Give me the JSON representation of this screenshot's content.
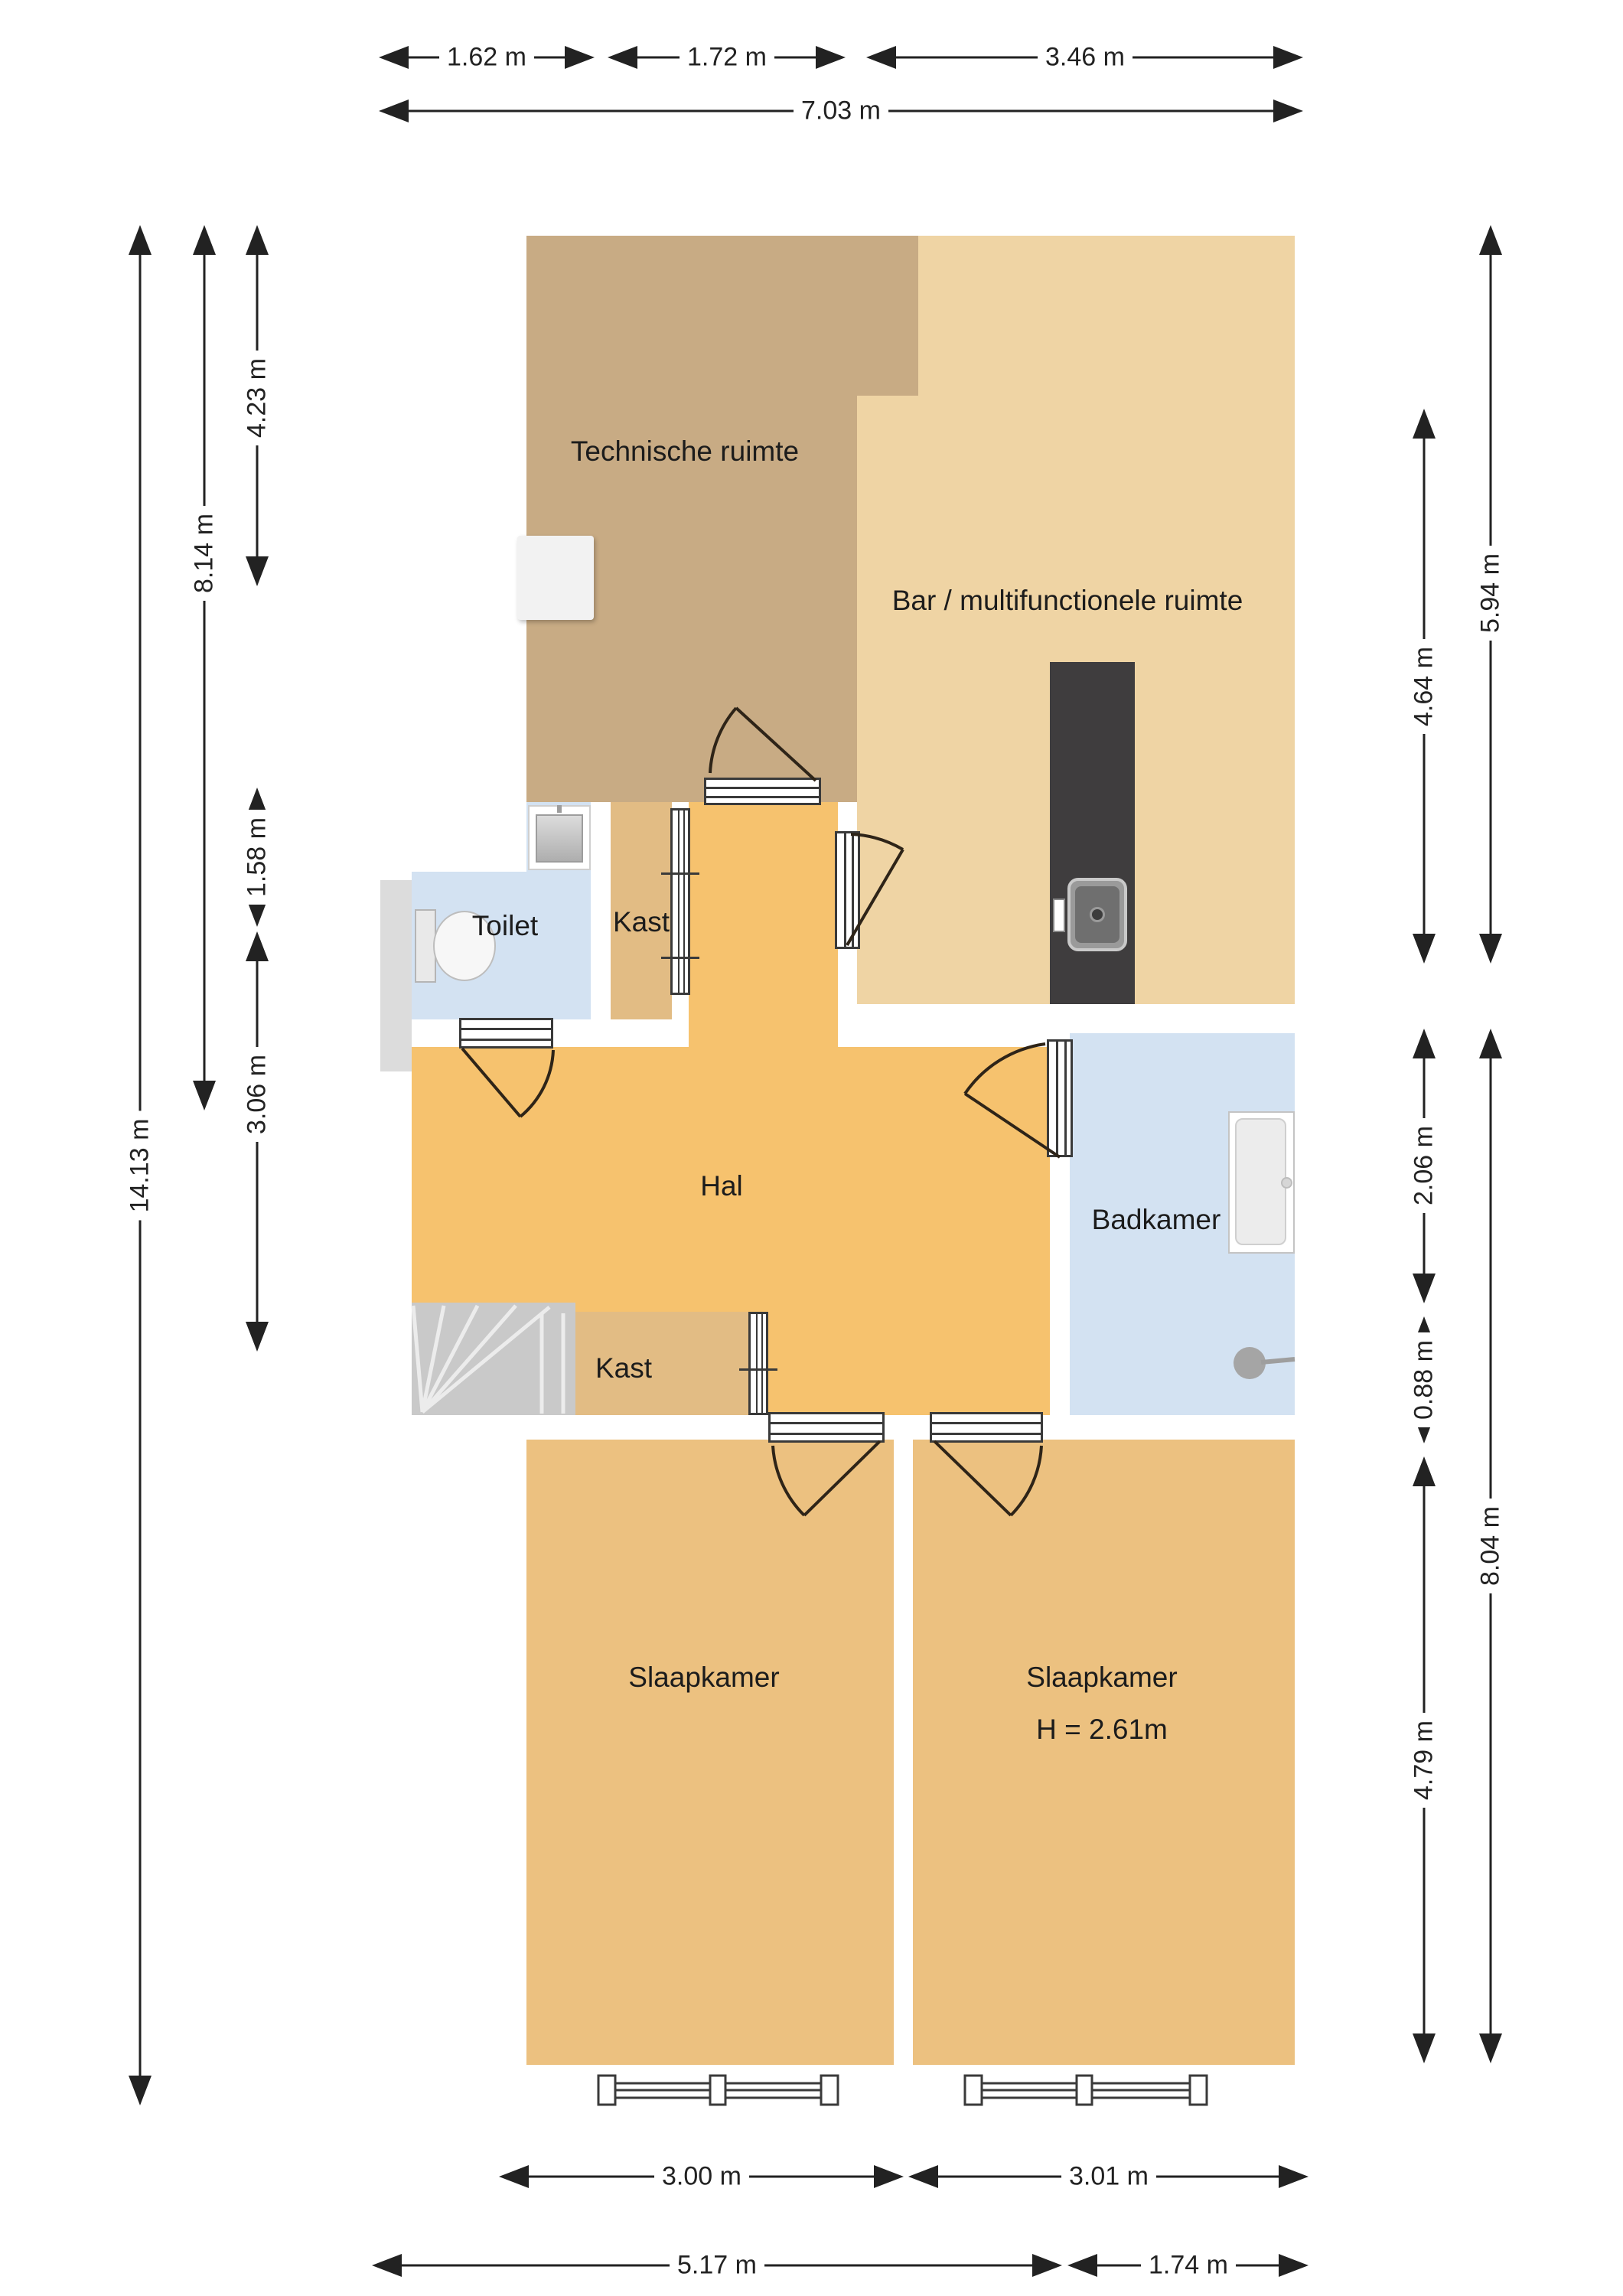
{
  "plan": {
    "title": "floor-plan",
    "colors": {
      "wall": "#0e0e0e",
      "tech": "#c8ab84",
      "bar": "#efd4a4",
      "hal": "#f6c26e",
      "bedroom": "#ecc180",
      "kast": "#e2bc84",
      "wet": "#d3e2f2",
      "stairs": "#c9c9c9",
      "counter": "#3f3d3e",
      "outside": "#ffffff"
    },
    "rooms": [
      {
        "id": "technische-ruimte",
        "label": "Technische ruimte"
      },
      {
        "id": "bar-multifunctionele-ruimte",
        "label": "Bar / multifunctionele ruimte"
      },
      {
        "id": "toilet",
        "label": "Toilet"
      },
      {
        "id": "kast-boven",
        "label": "Kast"
      },
      {
        "id": "hal",
        "label": "Hal"
      },
      {
        "id": "badkamer",
        "label": "Badkamer"
      },
      {
        "id": "kast-onder",
        "label": "Kast"
      },
      {
        "id": "slaapkamer-links",
        "label": "Slaapkamer"
      },
      {
        "id": "slaapkamer-rechts",
        "label": "Slaapkamer",
        "height_note": "H = 2.61m"
      }
    ],
    "dimensions": {
      "top": [
        {
          "label": "1.62 m"
        },
        {
          "label": "1.72 m"
        },
        {
          "label": "3.46 m"
        },
        {
          "label": "7.03 m"
        }
      ],
      "bottom": [
        {
          "label": "3.00 m"
        },
        {
          "label": "3.01 m"
        },
        {
          "label": "5.17 m"
        },
        {
          "label": "1.74 m"
        }
      ],
      "left": [
        {
          "label": "4.23 m"
        },
        {
          "label": "1.58 m"
        },
        {
          "label": "3.06 m"
        },
        {
          "label": "8.14 m"
        },
        {
          "label": "14.13 m"
        }
      ],
      "right": [
        {
          "label": "5.94 m"
        },
        {
          "label": "4.64 m"
        },
        {
          "label": "2.06 m"
        },
        {
          "label": "0.88 m"
        },
        {
          "label": "8.04 m"
        },
        {
          "label": "4.79 m"
        }
      ]
    },
    "fixtures": [
      "stairs",
      "bar-counter",
      "bar-sink",
      "toilet-wc",
      "toilet-sink",
      "bathtub",
      "shower-head",
      "appliance",
      "windows",
      "doors"
    ]
  }
}
